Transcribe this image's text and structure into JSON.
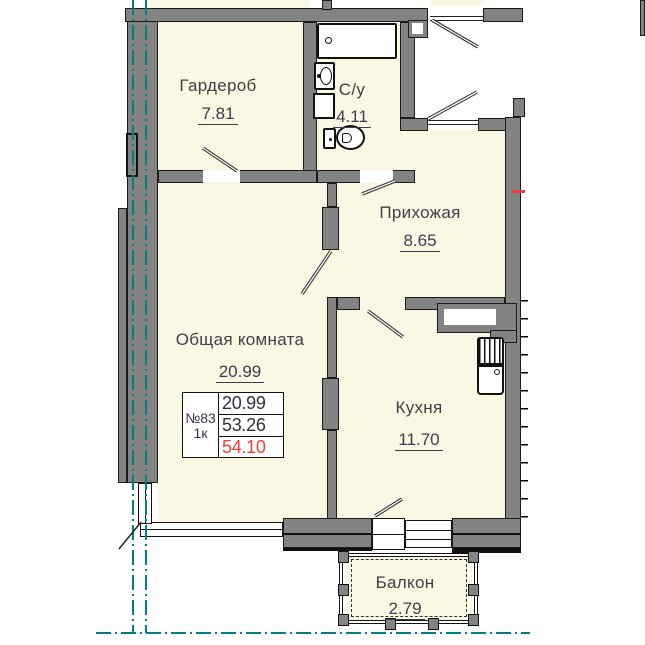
{
  "rooms": {
    "wardrobe": {
      "name": "Гардероб",
      "area": "7.81"
    },
    "bathroom": {
      "name": "С/у",
      "area": "4.11"
    },
    "hallway": {
      "name": "Прихожая",
      "area": "8.65"
    },
    "living_room": {
      "name": "Общая комната",
      "area": "20.99"
    },
    "kitchen": {
      "name": "Кухня",
      "area": "11.70"
    },
    "balcony": {
      "name": "Балкон",
      "area": "2.79"
    }
  },
  "unit_info": {
    "number": "№83",
    "type": "1к",
    "living_area": "20.99",
    "area": "53.26",
    "total_area": "54.10"
  },
  "colors": {
    "room_fill": "#faf8e2",
    "wall_gray": "#838383",
    "outline": "#1c1c1c",
    "axis_teal": "#00807e",
    "total_area_red": "#e8403a",
    "label_text": "#3f3f47"
  }
}
